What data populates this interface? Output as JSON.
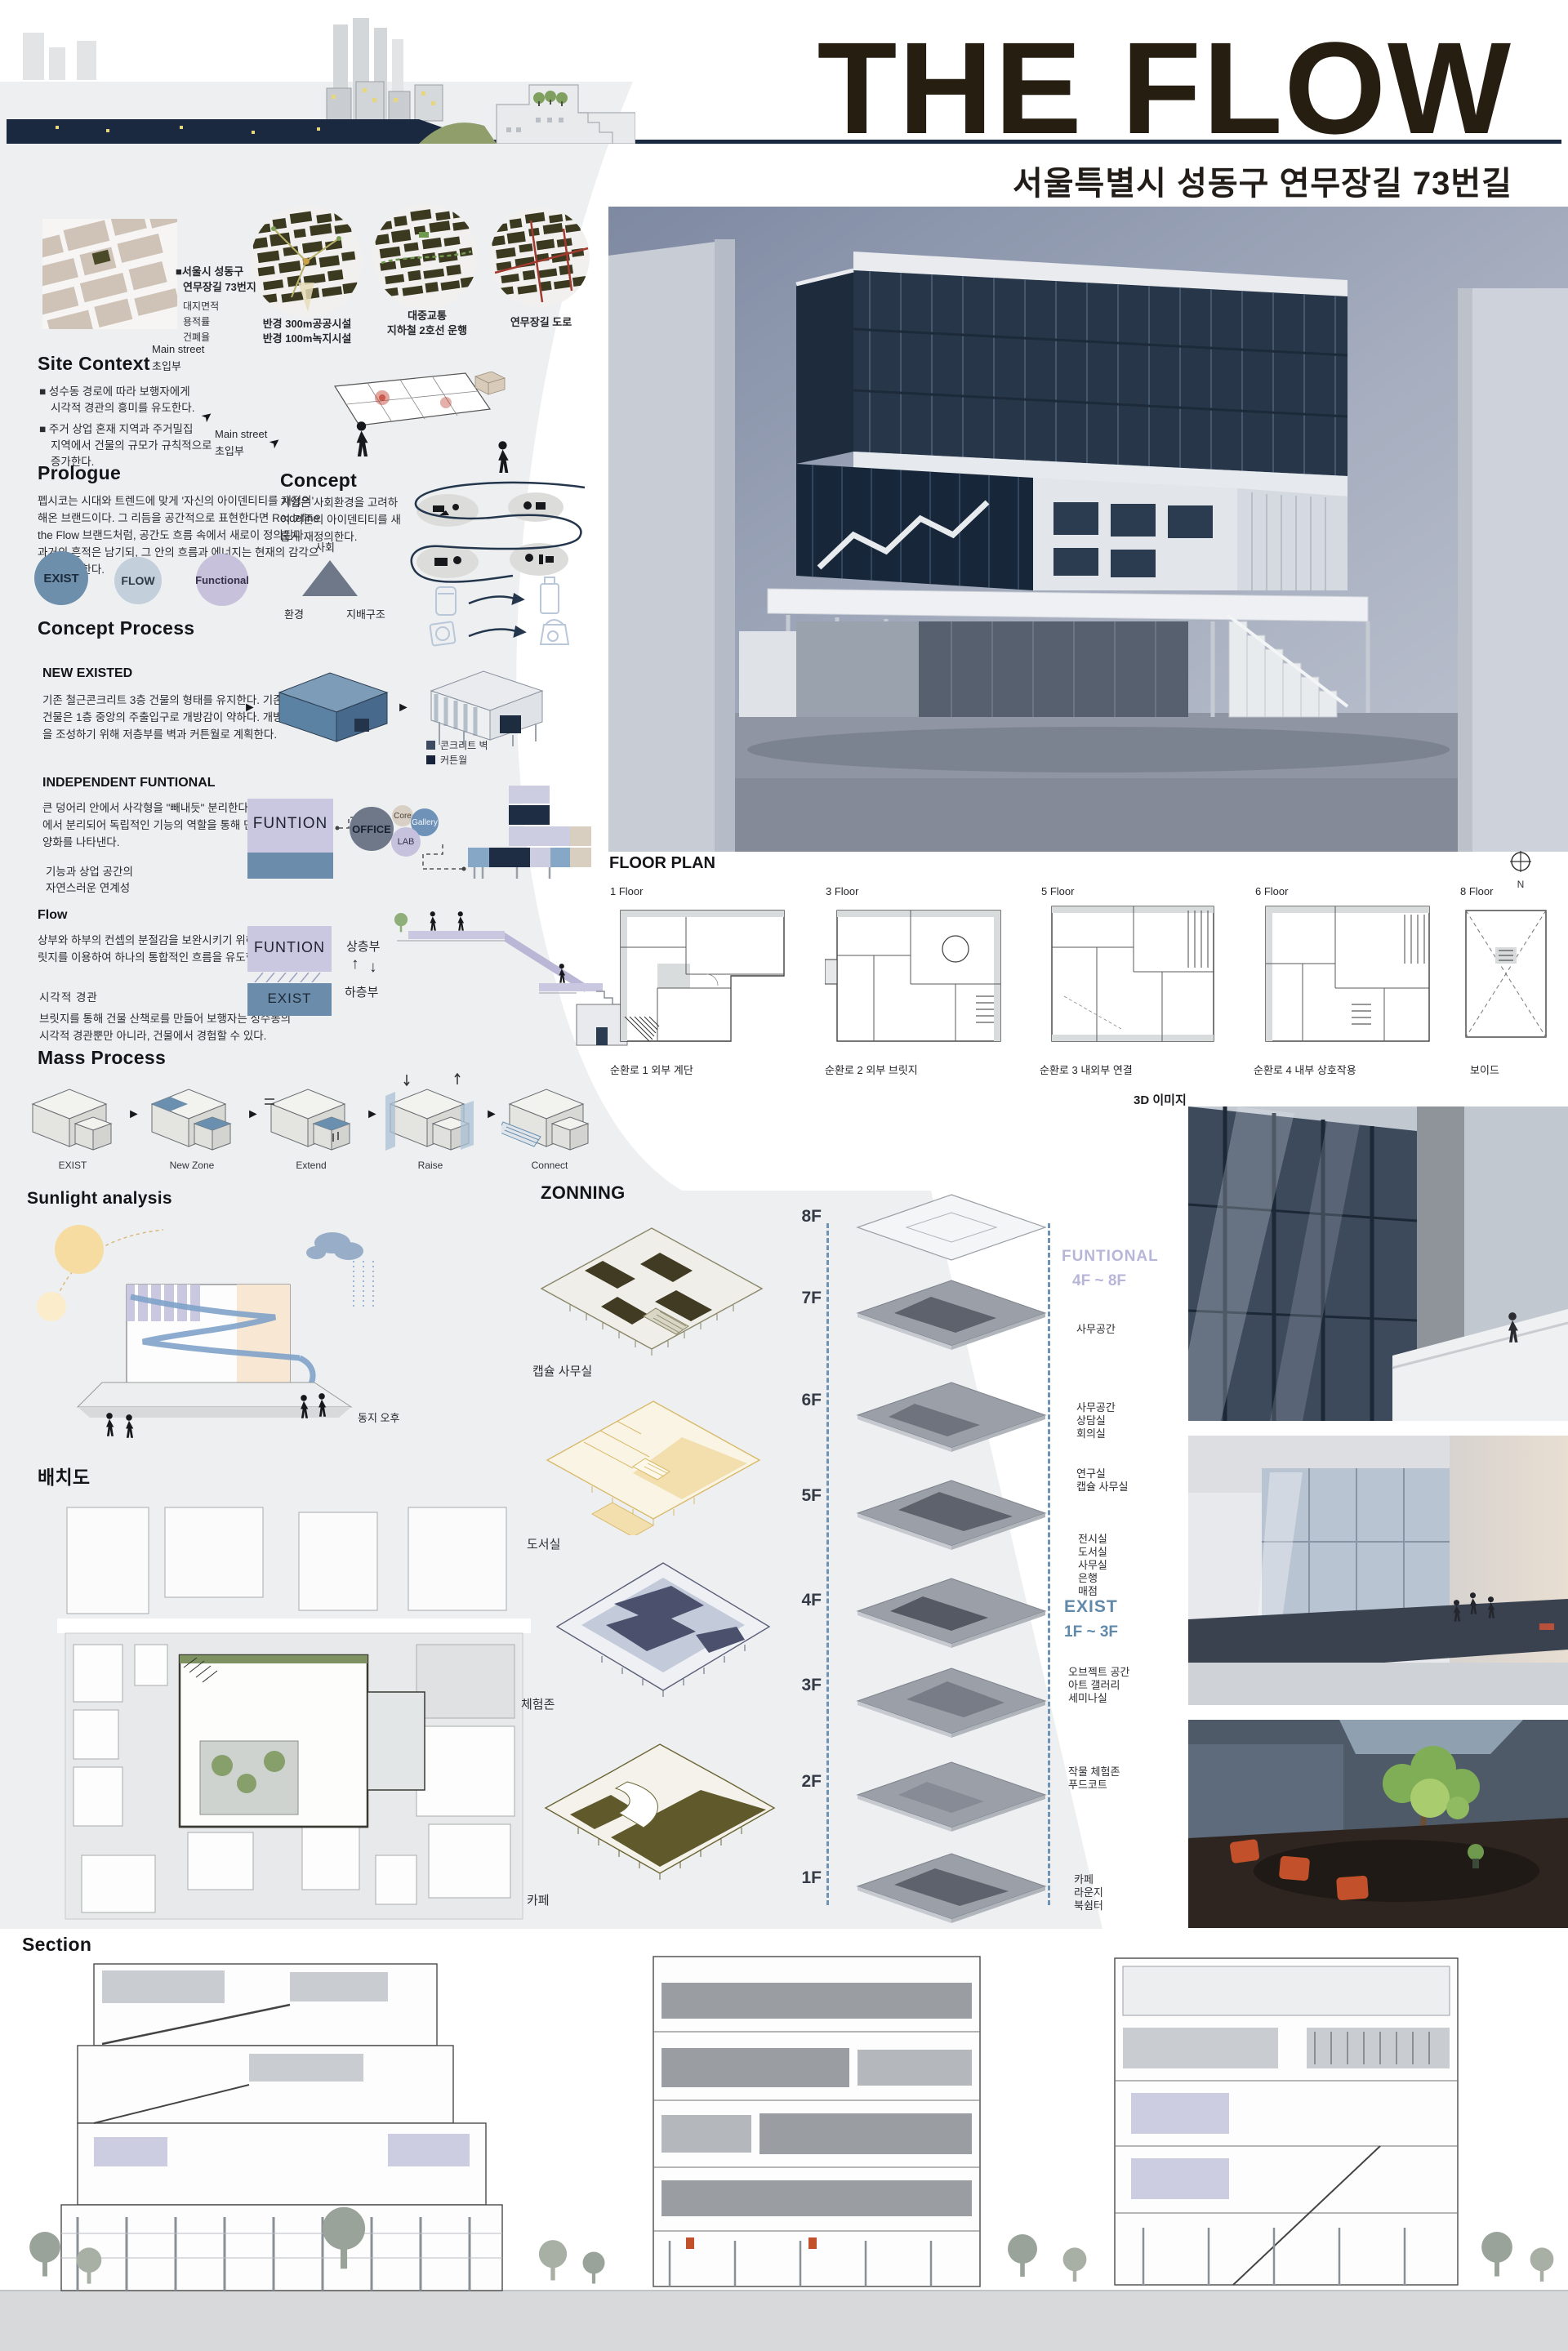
{
  "header": {
    "title": "THE FLOW",
    "subtitle": "서울특별시 성동구 연무장길 73번길"
  },
  "icons": {
    "arrow_right": "►",
    "arrow_ne": "➤",
    "arrow_up": "↑",
    "arrow_down": "↓"
  },
  "site_context": {
    "heading": "Site Context",
    "address_line1": "■서울시 성동구",
    "address_line2": "연무장길 73번지",
    "metric1": "대지면적",
    "metric2": "용적률",
    "metric3": "건폐율",
    "main_street_line1": "Main street",
    "main_street_line2": "초입부",
    "map1_caption1": "반경 300m공공시설",
    "map1_caption2": "반경 100m녹지시설",
    "map2_caption1": "대중교통",
    "map2_caption2": "지하철 2호선 운행",
    "map3_caption": "연무장길 도로",
    "bullet1_line1": "■ 성수동 경로에 따라 보행자에게",
    "bullet1_line2": "시각적 경관의 흥미를 유도한다.",
    "bullet2_line1": "■ 주거 상업 혼재 지역과 주거밀집",
    "bullet2_line2": "지역에서 건물의 규모가 규칙적으로",
    "bullet2_line3": "증가한다."
  },
  "prologue": {
    "heading": "Prologue",
    "body": "펩시코는 시대와 트렌드에 맞게 '자신의 아이덴티티를 재정의' 해온 브랜드이다. 그 리듬을 공간적으로 표현한다면  Re:define the Flow  브랜드처럼, 공간도 흐름 속에서 새로이 정의된다. 과거의 흔적은 남기되, 그 안의 흐름과 에너지는 현재의 감각으로 재구성한다.",
    "circle1": "EXIST",
    "circle2": "FLOW",
    "circle3": "Functional"
  },
  "concept": {
    "heading": "Concept",
    "body": "기업은 사회환경을 고려하여 기존의 아이덴티티를 새롭게 재정의한다.",
    "triangle_top": "사회",
    "triangle_left": "환경",
    "triangle_right": "지배구조",
    "main_street_line1": "Main street",
    "main_street_line2": "초입부"
  },
  "concept_process": {
    "heading": "Concept Process",
    "new_existed": {
      "heading": "NEW EXISTED",
      "body": "기존 철근콘크리트 3층 건물의 형태를 유지한다. 기존 건물은 1층 중앙의 주출입구로 개방감이 약하다. 개방감을 조성하기 위해 저층부를 벽과 커튼월로 계획한다.",
      "legend1": "콘크리트 벽",
      "legend2": "커튼월"
    },
    "independent": {
      "heading": "INDEPENDENT FUNTIONAL",
      "body1": "큰 덩어리 안에서 사각형을 \"빼내듯\" 분리한다. 단일화된 매스에서 분리되어 독립적인 기능의 역할을 통해 단일화 안에 다양화를 나타낸다.",
      "body2_line1": "기능과 상업 공간의",
      "body2_line2": "자연스러운 연계성",
      "funtion_label": "FUNTION",
      "office": "OFFICE",
      "core": "Core",
      "gallery": "Gallery",
      "lab": "LAB"
    }
  },
  "flow": {
    "heading": "Flow",
    "body1": "상부와 하부의 컨셉의 분절감을 보완시키기 위해 계단과 브릿지를 이용하여 하나의 통합적인 흐름을 유도한다.",
    "sub_heading": "시각적 경관",
    "body2": "브릿지를 통해 건물 산책로를 만들어 보행자는 성수동의 시각적 경관뿐만 아니라, 건물에서 경험할 수 있다.",
    "funtion_label": "FUNTION",
    "exist_label": "EXIST",
    "upper_label": "상층부",
    "lower_label": "하층부"
  },
  "mass_process": {
    "heading": "Mass Process",
    "steps": [
      "EXIST",
      "New Zone",
      "Extend",
      "Raise",
      "Connect"
    ]
  },
  "sunlight": {
    "heading": "Sunlight analysis",
    "label": "동지 오후"
  },
  "siteplan": {
    "heading": "배치도"
  },
  "floorplan": {
    "heading": "FLOOR PLAN",
    "north_label": "N",
    "items": [
      {
        "floor": "1 Floor",
        "caption": "순환로 1 외부 계단"
      },
      {
        "floor": "3 Floor",
        "caption": "순환로 2 외부 브릿지"
      },
      {
        "floor": "5 Floor",
        "caption": "순환로 3 내외부 연결"
      },
      {
        "floor": "6 Floor",
        "caption": "순환로 4 내부 상호작용"
      },
      {
        "floor": "8 Floor",
        "caption": "보이드"
      }
    ]
  },
  "zoning": {
    "heading": "ZONNING",
    "zone_labels": [
      "캡슐 사무실",
      "도서실",
      "체험존",
      "카페"
    ],
    "floor_labels": [
      "8F",
      "7F",
      "6F",
      "5F",
      "4F",
      "3F",
      "2F",
      "1F"
    ],
    "funtional_label": "FUNTIONAL",
    "funtional_range": "4F ~ 8F",
    "exist_label": "EXIST",
    "exist_range": "1F ~ 3F",
    "ann_8f": "사무공간",
    "ann_7f": [
      "사무공간",
      "상담실",
      "회의실"
    ],
    "ann_6f": [
      "연구실",
      "캡슐 사무실"
    ],
    "ann_5f": [
      "전시실",
      "도서실",
      "사무실",
      "은행",
      "매점"
    ],
    "ann_3f": [
      "오브젝트 공간",
      "아트 갤러리",
      "세미나실"
    ],
    "ann_2f": [
      "작물 체험존",
      "푸드코트"
    ],
    "ann_1f": [
      "카페",
      "라운지",
      "북쉼터"
    ]
  },
  "renders": {
    "heading": "3D 이미지"
  },
  "section": {
    "heading": "Section"
  },
  "colors": {
    "accent_navy": "#1b2940",
    "accent_blue": "#6b8cab",
    "accent_lavender": "#cac7e0",
    "funtional_text": "#b7b6d8",
    "exist_text": "#6189a9",
    "title_brown": "#271e12",
    "zone_olive": "#8a8668",
    "zone_yellow": "#d9b96a",
    "zone_navy": "#4b516d",
    "zone_khaki": "#5f592c"
  }
}
